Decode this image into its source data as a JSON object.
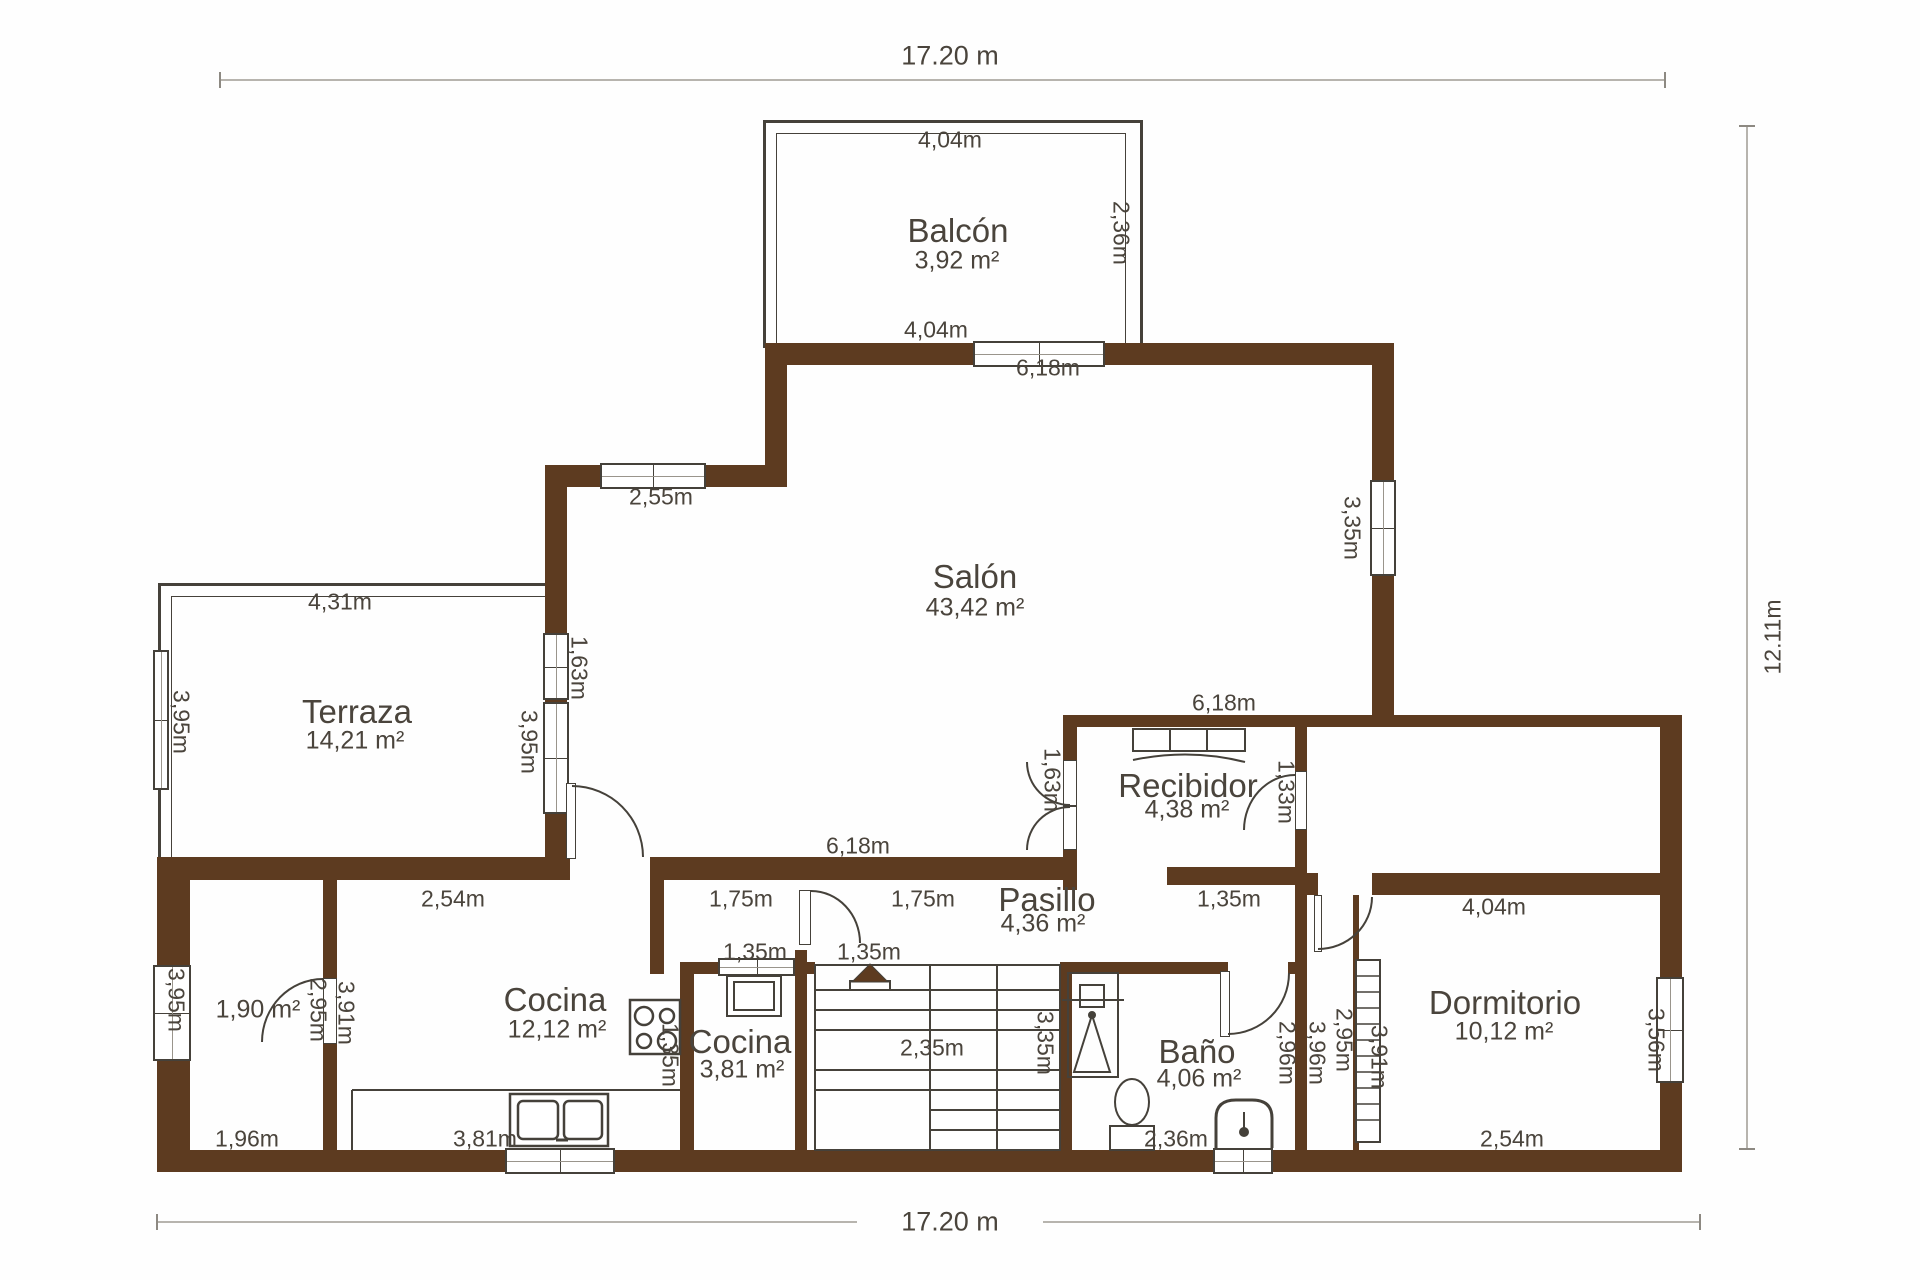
{
  "plan_title": "floor-plan",
  "colors": {
    "wall": "#5d3b20",
    "line": "#45413a",
    "text": "#4a443c",
    "dimline": "#b7b4ae",
    "background": "#fefefe"
  },
  "overall_dimensions": {
    "top": "17.20 m",
    "bottom": "17.20 m",
    "right": "12.11m"
  },
  "rooms": [
    {
      "id": "balcon",
      "name": "Balcón",
      "area": "3,92 m²",
      "nx": 958,
      "ny": 231,
      "ax": 957,
      "ay": 261
    },
    {
      "id": "salon",
      "name": "Salón",
      "area": "43,42 m²",
      "nx": 975,
      "ny": 577,
      "ax": 975,
      "ay": 608
    },
    {
      "id": "terraza",
      "name": "Terraza",
      "area": "14,21 m²",
      "nx": 357,
      "ny": 712,
      "ax": 355,
      "ay": 741
    },
    {
      "id": "cocina",
      "name": "Cocina",
      "area": "12,12 m²",
      "nx": 555,
      "ny": 1000,
      "ax": 557,
      "ay": 1030
    },
    {
      "id": "cocina-2",
      "name": "Cocina",
      "area": "3,81 m²",
      "nx": 740,
      "ny": 1042,
      "ax": 742,
      "ay": 1070
    },
    {
      "id": "bano",
      "name": "Baño",
      "area": "4,06 m²",
      "nx": 1197,
      "ny": 1052,
      "ax": 1199,
      "ay": 1079
    },
    {
      "id": "recibidor",
      "name": "Recibidor",
      "area": "4,38 m²",
      "nx": 1188,
      "ny": 786,
      "ax": 1187,
      "ay": 810
    },
    {
      "id": "pasillo",
      "name": "Pasillo",
      "area": "4,36 m²",
      "nx": 1047,
      "ny": 900,
      "ax": 1043,
      "ay": 924
    },
    {
      "id": "dormitorio",
      "name": "Dormitorio",
      "area": "10,12 m²",
      "nx": 1505,
      "ny": 1003,
      "ax": 1504,
      "ay": 1032
    },
    {
      "id": "trastero",
      "name": "",
      "area": "1,90 m²",
      "nx": 258,
      "ny": 985,
      "ax": 258,
      "ay": 1010
    }
  ],
  "dims": [
    {
      "text": "17.20 m",
      "x": 950,
      "y": 56,
      "rot": 0,
      "big": true
    },
    {
      "text": "4,04m",
      "x": 950,
      "y": 140,
      "rot": 0
    },
    {
      "text": "2,36m",
      "x": 1121,
      "y": 233,
      "rot": 90
    },
    {
      "text": "4,04m",
      "x": 936,
      "y": 330,
      "rot": 0
    },
    {
      "text": "6,18m",
      "x": 1048,
      "y": 368,
      "rot": 0
    },
    {
      "text": "2,55m",
      "x": 661,
      "y": 497,
      "rot": 0
    },
    {
      "text": "3,35m",
      "x": 1352,
      "y": 528,
      "rot": 90
    },
    {
      "text": "4,31m",
      "x": 340,
      "y": 602,
      "rot": 0
    },
    {
      "text": "3,95m",
      "x": 181,
      "y": 722,
      "rot": 90
    },
    {
      "text": "1,63m",
      "x": 579,
      "y": 668,
      "rot": 90
    },
    {
      "text": "3,95m",
      "x": 529,
      "y": 742,
      "rot": 90
    },
    {
      "text": "6,18m",
      "x": 858,
      "y": 846,
      "rot": 0
    },
    {
      "text": "6,18m",
      "x": 1224,
      "y": 703,
      "rot": 0
    },
    {
      "text": "2,54m",
      "x": 453,
      "y": 899,
      "rot": 0
    },
    {
      "text": "1,75m",
      "x": 741,
      "y": 899,
      "rot": 0
    },
    {
      "text": "1,75m",
      "x": 923,
      "y": 899,
      "rot": 0
    },
    {
      "text": "1,35m",
      "x": 1229,
      "y": 899,
      "rot": 0
    },
    {
      "text": "1,35m",
      "x": 755,
      "y": 952,
      "rot": 0
    },
    {
      "text": "1,35m",
      "x": 869,
      "y": 952,
      "rot": 0
    },
    {
      "text": "1,63m",
      "x": 1052,
      "y": 780,
      "rot": 90
    },
    {
      "text": "1,33m",
      "x": 1286,
      "y": 792,
      "rot": 90
    },
    {
      "text": "3,95m",
      "x": 176,
      "y": 1000,
      "rot": 90
    },
    {
      "text": "2,95m",
      "x": 318,
      "y": 1010,
      "rot": 90
    },
    {
      "text": "3,91m",
      "x": 346,
      "y": 1013,
      "rot": 90
    },
    {
      "text": "1,96m",
      "x": 247,
      "y": 1139,
      "rot": 0
    },
    {
      "text": "3,81m",
      "x": 485,
      "y": 1139,
      "rot": 0
    },
    {
      "text": "1,35m",
      "x": 670,
      "y": 1055,
      "rot": 90
    },
    {
      "text": "2,35m",
      "x": 932,
      "y": 1048,
      "rot": 0
    },
    {
      "text": "3,35m",
      "x": 1045,
      "y": 1043,
      "rot": 90
    },
    {
      "text": "2,36m",
      "x": 1176,
      "y": 1139,
      "rot": 0
    },
    {
      "text": "2,96m",
      "x": 1287,
      "y": 1053,
      "rot": 90
    },
    {
      "text": "3,96m",
      "x": 1317,
      "y": 1053,
      "rot": 90
    },
    {
      "text": "2,95m",
      "x": 1344,
      "y": 1040,
      "rot": 90
    },
    {
      "text": "3,91m",
      "x": 1379,
      "y": 1057,
      "rot": 90
    },
    {
      "text": "4,04m",
      "x": 1494,
      "y": 907,
      "rot": 0
    },
    {
      "text": "3,56m",
      "x": 1656,
      "y": 1040,
      "rot": 90
    },
    {
      "text": "2,54m",
      "x": 1512,
      "y": 1139,
      "rot": 0
    },
    {
      "text": "17.20 m",
      "x": 950,
      "y": 1222,
      "rot": 0,
      "big": true
    },
    {
      "text": "12.11m",
      "x": 1773,
      "y": 637,
      "rot": -90
    }
  ]
}
